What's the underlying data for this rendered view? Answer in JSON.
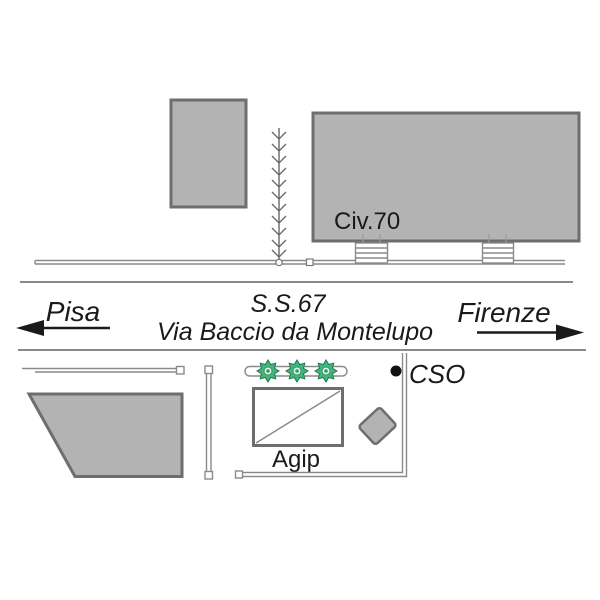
{
  "map": {
    "labels": {
      "building_number": "Civ.70",
      "direction_left": "Pisa",
      "route_number": "S.S.67",
      "street_name": "Via Baccio da Montelupo",
      "direction_right": "Firenze",
      "gas_station": "Agip",
      "destination": "CSO"
    },
    "colors": {
      "building_fill": "#b3b3b3",
      "building_stroke": "#6e6e6e",
      "road_line": "#8a8a8a",
      "text": "#1a1a1a",
      "arrow": "#1a1a1a",
      "bush_green": "#46b27e",
      "bush_dark_green": "#1d7a4a",
      "marker_dot": "#111111"
    }
  }
}
